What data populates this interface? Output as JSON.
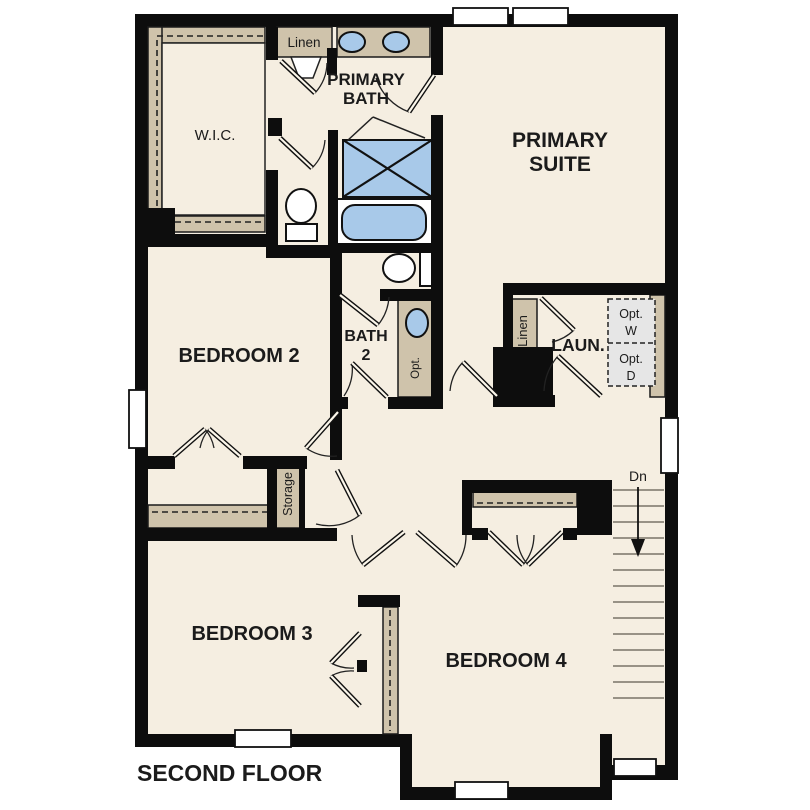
{
  "plan": {
    "floor_title": "SECOND FLOOR",
    "labels": {
      "wic": "W.I.C.",
      "linen_top": "Linen",
      "primary_bath_line1": "PRIMARY",
      "primary_bath_line2": "BATH",
      "primary_suite_line1": "PRIMARY",
      "primary_suite_line2": "SUITE",
      "bedroom2": "BEDROOM 2",
      "bath2_line1": "BATH",
      "bath2_line2": "2",
      "opt_sink": "Opt.",
      "linen_laundry": "Linen",
      "laundry": "LAUN.",
      "opt_washer_line1": "Opt.",
      "opt_washer_line2": "W",
      "opt_dryer_line1": "Opt.",
      "opt_dryer_line2": "D",
      "stairs_down": "Dn",
      "storage": "Storage",
      "bedroom3": "BEDROOM 3",
      "bedroom4": "BEDROOM 4"
    },
    "colors": {
      "wall": "#0d0d0d",
      "floor": "#f5eee1",
      "closet_shelf_tan": "#cfc3ab",
      "fixture_blue": "#a8c9e9",
      "optional_appliance_gray": "#e6e6e6",
      "window_white": "#ffffff"
    }
  }
}
